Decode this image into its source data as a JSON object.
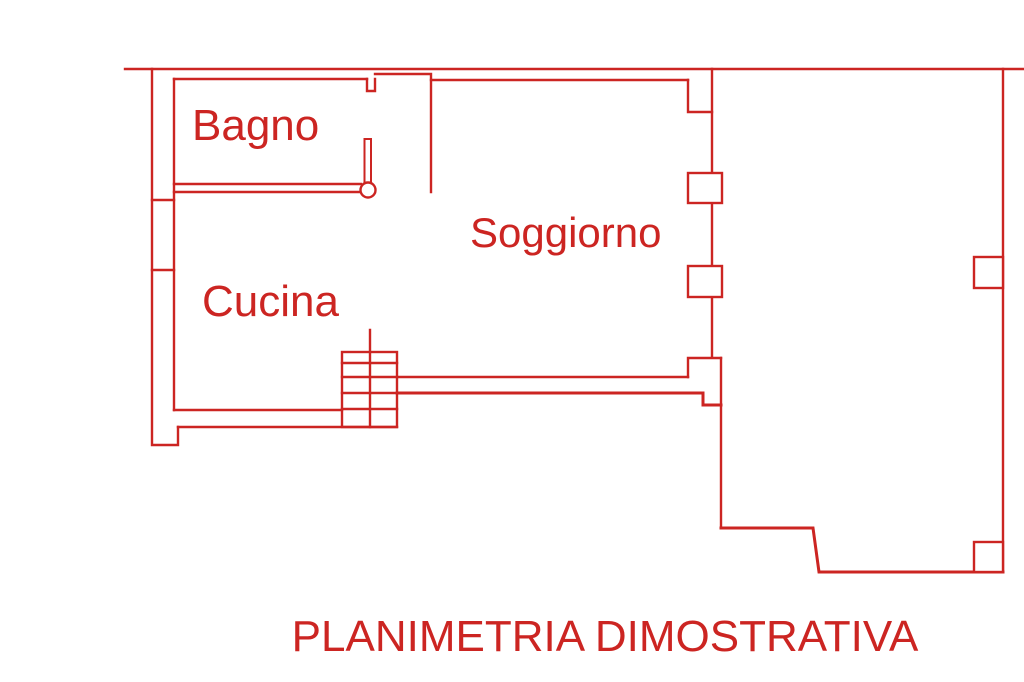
{
  "plan": {
    "title": "PLANIMETRIA DIMOSTRATIVA",
    "rooms": [
      {
        "id": "bagno",
        "label": "Bagno"
      },
      {
        "id": "soggiorno",
        "label": "Soggiorno"
      },
      {
        "id": "cucina",
        "label": "Cucina"
      }
    ],
    "colors": {
      "line": "#cc2522",
      "background": "#ffffff"
    }
  }
}
